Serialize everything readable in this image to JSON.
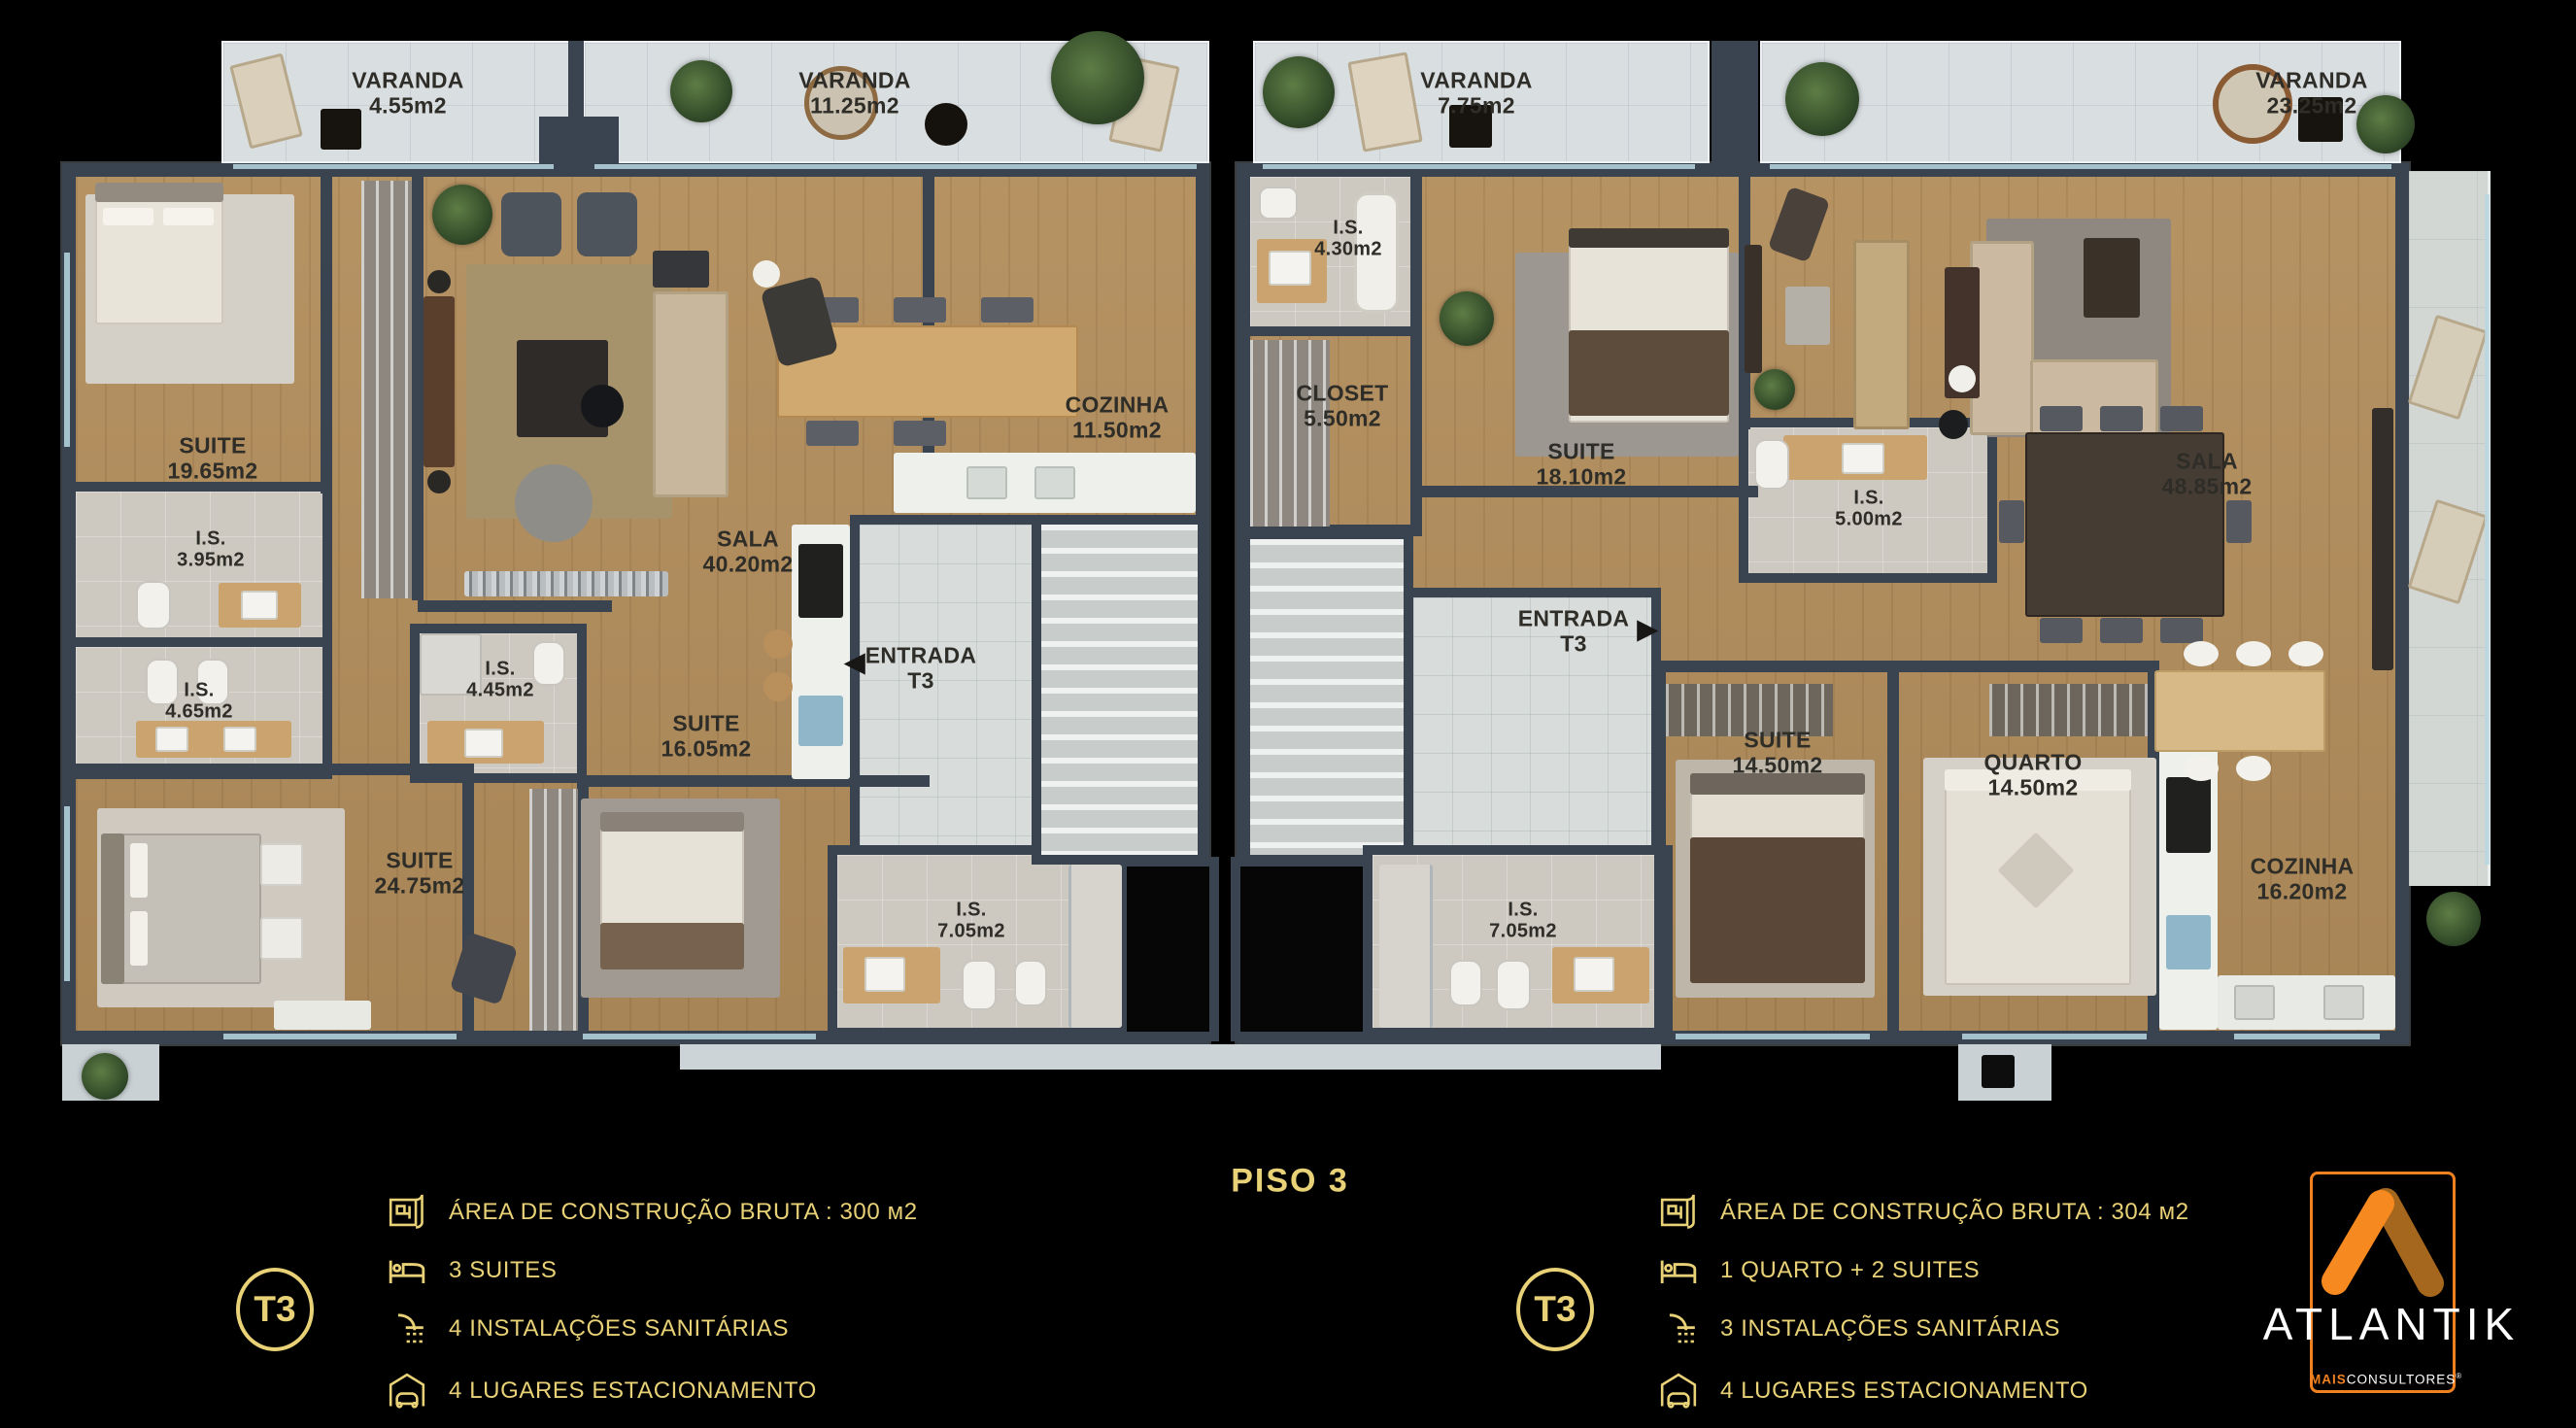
{
  "plan": {
    "title": "PISO 3",
    "rooms": {
      "varanda1": {
        "name": "VARANDA",
        "area": "4.55m2"
      },
      "varanda2": {
        "name": "VARANDA",
        "area": "11.25m2"
      },
      "varanda3": {
        "name": "VARANDA",
        "area": "7.75m2"
      },
      "varanda4": {
        "name": "VARANDA",
        "area": "23.25m2"
      },
      "suite1965": {
        "name": "SUITE",
        "area": "19.65m2"
      },
      "is395": {
        "name": "I.S.",
        "area": "3.95m2"
      },
      "is465": {
        "name": "I.S.",
        "area": "4.65m2"
      },
      "is445": {
        "name": "I.S.",
        "area": "4.45m2"
      },
      "suite2475": {
        "name": "SUITE",
        "area": "24.75m2"
      },
      "suite1605": {
        "name": "SUITE",
        "area": "16.05m2"
      },
      "sala_l": {
        "name": "SALA",
        "area": "40.20m2"
      },
      "cozinha_l": {
        "name": "COZINHA",
        "area": "11.50m2"
      },
      "entrada_l": {
        "name": "ENTRADA",
        "unit": "T3",
        "arrow": "◀"
      },
      "is705_l": {
        "name": "I.S.",
        "area": "7.05m2"
      },
      "is430": {
        "name": "I.S.",
        "area": "4.30m2"
      },
      "closet": {
        "name": "CLOSET",
        "area": "5.50m2"
      },
      "suite1810": {
        "name": "SUITE",
        "area": "18.10m2"
      },
      "is500": {
        "name": "I.S.",
        "area": "5.00m2"
      },
      "sala_r": {
        "name": "SALA",
        "area": "48.85m2"
      },
      "entrada_r": {
        "name": "ENTRADA",
        "unit": "T3",
        "arrow": "▶"
      },
      "is705_r": {
        "name": "I.S.",
        "area": "7.05m2"
      },
      "suite1450": {
        "name": "SUITE",
        "area": "14.50m2"
      },
      "quarto": {
        "name": "QUARTO",
        "area": "14.50m2"
      },
      "cozinha_r": {
        "name": "COZINHA",
        "area": "16.20m2"
      }
    }
  },
  "legends": {
    "left": {
      "unit": "T3",
      "items": [
        {
          "icon": "blueprint-icon",
          "text": "ÁREA DE CONSTRUÇÃO BRUTA :  300 м2"
        },
        {
          "icon": "bed-icon",
          "text": "3 SUITES"
        },
        {
          "icon": "shower-icon",
          "text": "4 INSTALAÇÕES SANITÁRIAS"
        },
        {
          "icon": "garage-icon",
          "text": "4 LUGARES ESTACIONAMENTO"
        }
      ]
    },
    "right": {
      "unit": "T3",
      "items": [
        {
          "icon": "blueprint-icon",
          "text": "ÁREA DE CONSTRUÇÃO BRUTA :  304 м2"
        },
        {
          "icon": "bed-icon",
          "text": "1 QUARTO + 2 SUITES"
        },
        {
          "icon": "shower-icon",
          "text": "3 INSTALAÇÕES SANITÁRIAS"
        },
        {
          "icon": "garage-icon",
          "text": "4 LUGARES ESTACIONAMENTO"
        }
      ]
    }
  },
  "logo": {
    "brand": "ATLANTIK",
    "sub_bold": "MAIS",
    "sub_rest": "CONSULTORES",
    "registered": "®"
  },
  "colors": {
    "gold": "#E8D176",
    "orange": "#F08120",
    "wall": "#3A4450",
    "wood": "#B28D5B",
    "background": "#000000"
  }
}
